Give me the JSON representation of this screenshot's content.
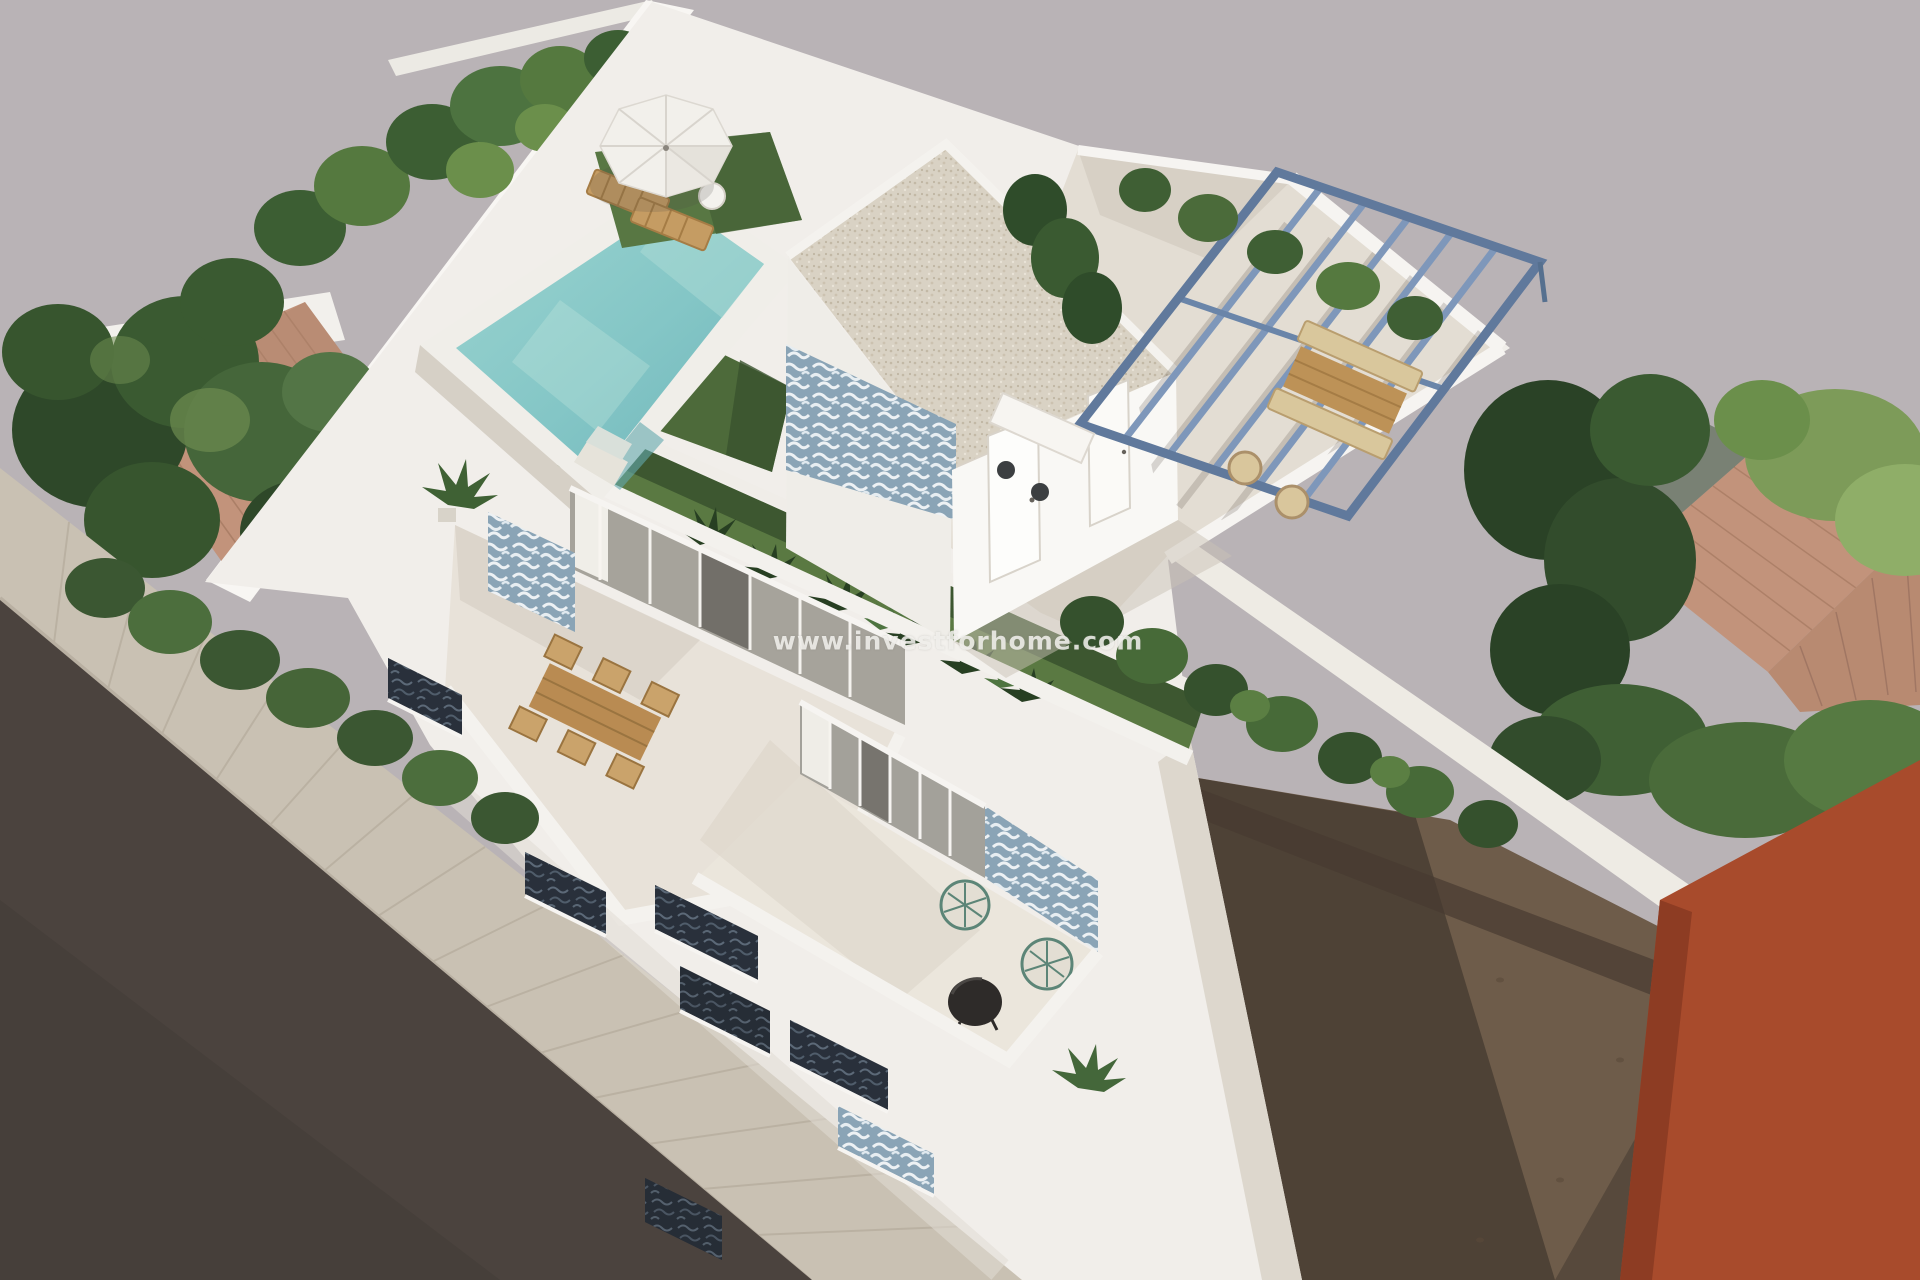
{
  "meta": {
    "type": "3d-architectural-render",
    "view": "aerial-oblique",
    "description": "Bird's-eye 3D rendering of a modern white two-storey villa: rooftop pool with parasol and loungers, roof-access room with gravel roof and blue patterned tile mural, steel-blue pergola over an outdoor dining terrace, green roof turf strips, first-floor terrace with wooden dining table, ground-floor patio with two string chairs and a round table, street facade with dark shuttered balconies, neighbouring terracotta roofs and trees, street with sidewalk, vacant dirt plot and an orange neighbouring building."
  },
  "watermark": {
    "text": "www.investforhome.com"
  },
  "palette": {
    "background": "#b9b3b6",
    "road": "#4b433e",
    "sidewalk": "#c9c1b3",
    "dirt": "#6e5c4a",
    "dirt_shadow": "#493d32",
    "orange_building": "#a84b2c",
    "villa_white": "#f1eeea",
    "floor_beige": "#e3ddd3",
    "pool_water": "#8ccac9",
    "turf": "#5a7942",
    "turf_shadow": "#3a532f",
    "tile_blue": "#8aa4b6",
    "pergola_steel": "#7e97ba",
    "wood": "#bd9257",
    "terracotta_roof": "#c2937b",
    "tree_dark": "#324c2c",
    "tree_light": "#7d9b59",
    "gravel_roof": "#d9d2c4"
  },
  "scene": {
    "objects": [
      "rooftop swimming pool",
      "white parasol with two wooden sun loungers",
      "roof-access room with gravel roof and blue tile mural",
      "steel-blue pergola with wooden dining set and wicker chairs",
      "green roof turf strip with tropical plants",
      "first-floor terrace with wooden dining table and six chairs",
      "ground-floor patio with two string chairs and round black table",
      "street facade with dark shuttered balcony openings",
      "left neighbour house with terracotta roof and trees",
      "right neighbour terracotta roof and trees",
      "street with paved sidewalk",
      "vacant dirt plot",
      "orange neighbouring building"
    ]
  }
}
